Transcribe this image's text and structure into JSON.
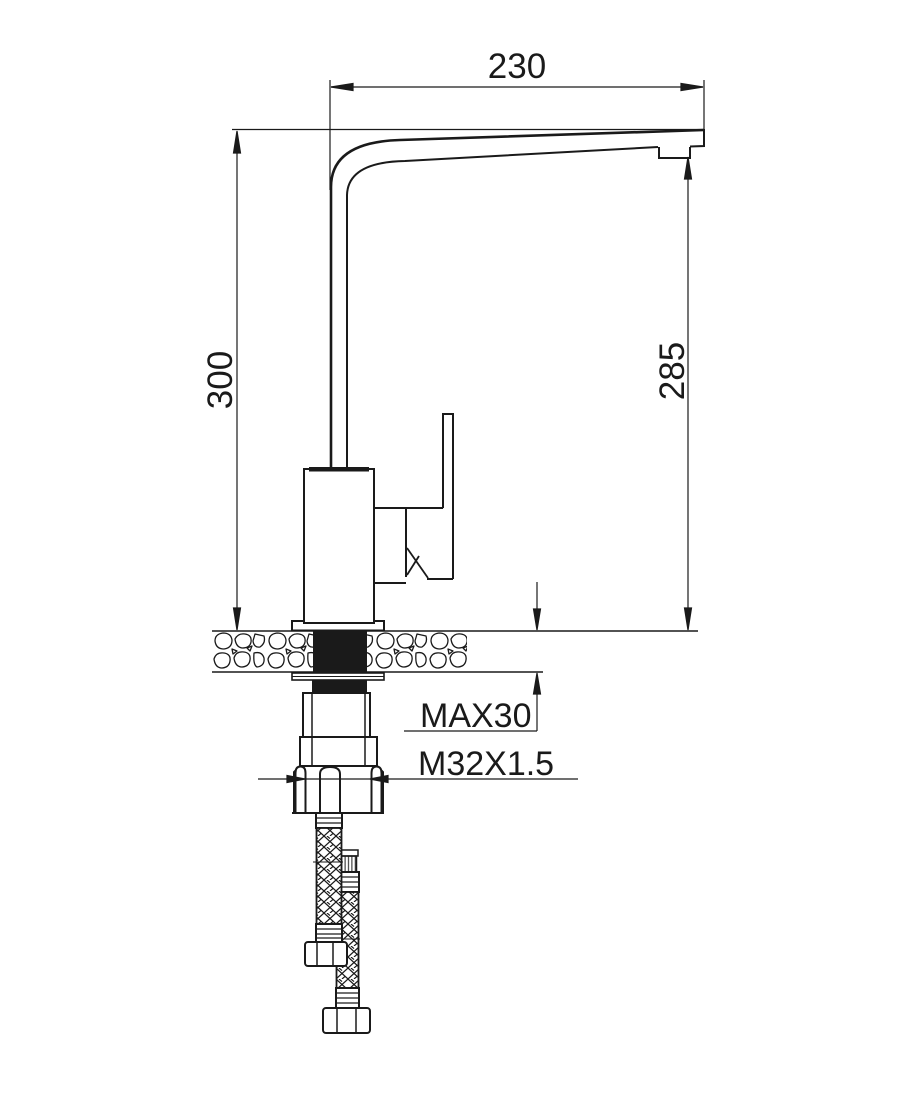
{
  "drawing": {
    "kind": "technical installation drawing",
    "subject": "single-lever kitchen faucet, side elevation with mounting cross-section",
    "background_color": "#ffffff",
    "line_color": "#1a1a1a",
    "labels": {
      "spout_reach": "230",
      "overall_height": "300",
      "spout_height": "285",
      "max_counter_thickness": "MAX30",
      "thread_size": "M32X1.5"
    }
  }
}
